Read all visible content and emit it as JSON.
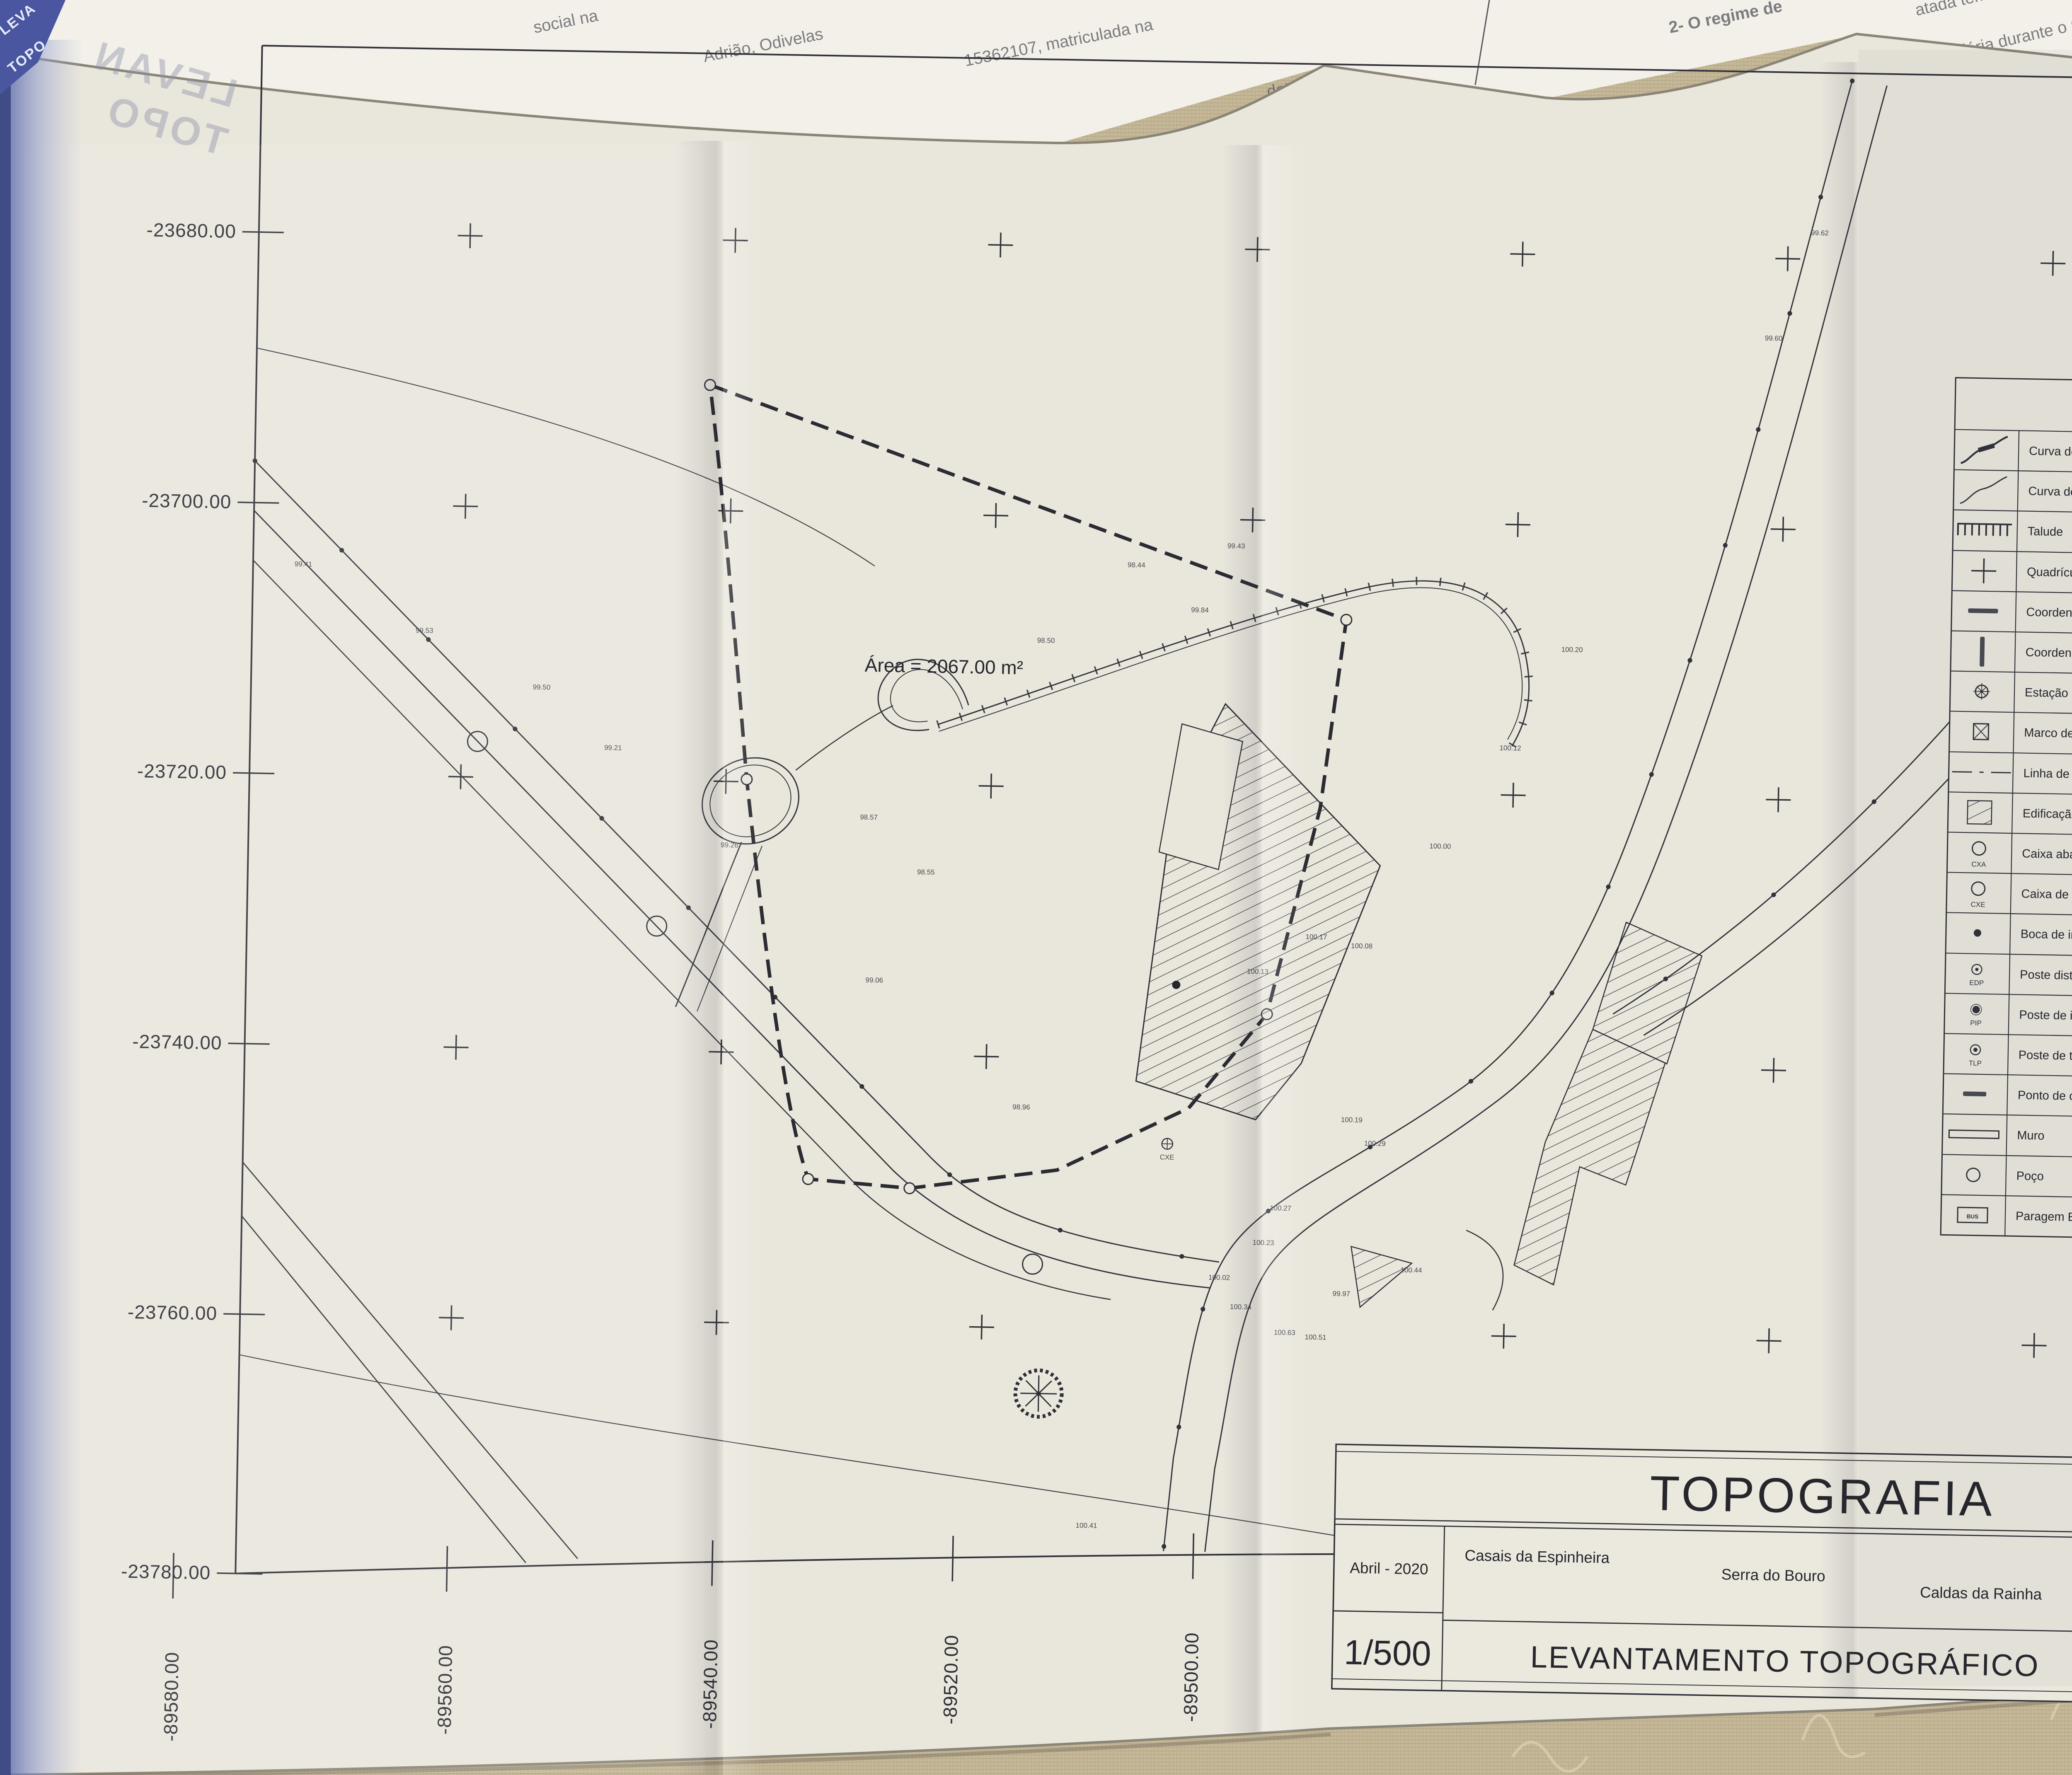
{
  "photo": {
    "cover": {
      "line1": "LEVA",
      "line2": "TOPO"
    },
    "ghost": {
      "line1": "LEVAN",
      "line2": "TOPO"
    },
    "top_fragments": [
      "social na",
      "Adrião, Odivelas",
      "15362107, matriculada na",
      "detentora da",
      "do",
      "2- O regime de",
      "atada tem",
      "ção imobiliária durante o resp",
      "áusula 5.ª",
      "ressado que"
    ],
    "right_fragments": [
      "de",
      "iço",
      "do",
      "de",
      "e",
      "s"
    ]
  },
  "axes": {
    "left": [
      "-23680.00",
      "-23700.00",
      "-23720.00",
      "-23740.00",
      "-23760.00",
      "-23780.00"
    ],
    "bottom": [
      "-89580.00",
      "-89560.00",
      "-89540.00",
      "-89520.00",
      "-89500.00"
    ]
  },
  "map": {
    "area_label": "Área = 2067.00 m²",
    "cxe_label": "CXE",
    "spots": [
      "99.41",
      "99.53",
      "99.50",
      "99.21",
      "99.26",
      "99.06",
      "98.96",
      "98.57",
      "98.55",
      "98.50",
      "98.44",
      "99.43",
      "100.00",
      "100.12",
      "100.20",
      "100.08",
      "100.13",
      "100.17",
      "100.27",
      "100.02",
      "100.23",
      "100.34",
      "100.63",
      "100.51",
      "99.97",
      "100.44",
      "100.29",
      "100.19",
      "99.60",
      "99.62",
      "100.41",
      "99.84"
    ]
  },
  "north": {
    "label": "NORTE"
  },
  "legend": {
    "title": "SIMBOLOGIA",
    "items": [
      {
        "label": "Curva de nível mestra com cota"
      },
      {
        "label": "Curva de nível secundária"
      },
      {
        "label": "Talude"
      },
      {
        "label": "Quadrícula de coordenação"
      },
      {
        "label": "Coordenada p"
      },
      {
        "label": "Coordenada m"
      },
      {
        "label": "Estação"
      },
      {
        "label": "Marco de estrema de propriedade"
      },
      {
        "label": "Linha de estrema"
      },
      {
        "label": "Edificação"
      },
      {
        "label": "Caixa abastecimento de água",
        "sub": "CXA"
      },
      {
        "label": "Caixa de esgoto doméstico",
        "sub": "CXE"
      },
      {
        "label": "Boca de incêndio"
      },
      {
        "label": "Poste distribuição EDP",
        "sub": "EDP"
      },
      {
        "label": "Poste de iluminação",
        "sub": "PIP"
      },
      {
        "label": "Poste de telecomunicações",
        "sub": "TLP"
      },
      {
        "label": "Ponto de cota"
      },
      {
        "label": "Muro"
      },
      {
        "label": "Poço"
      },
      {
        "label": "Paragem BUS",
        "sub": "BUS"
      }
    ]
  },
  "title_block": {
    "title": "TOPOGRAFIA",
    "date": "Abril - 2020",
    "locality": "Casais da Espinheira",
    "parish": "Serra do Bouro",
    "municipality": "Caldas da Rainha",
    "scale": "1/500",
    "subtitle": "LEVANTAMENTO TOPOGRÁFICO",
    "sheet_number": "02"
  }
}
